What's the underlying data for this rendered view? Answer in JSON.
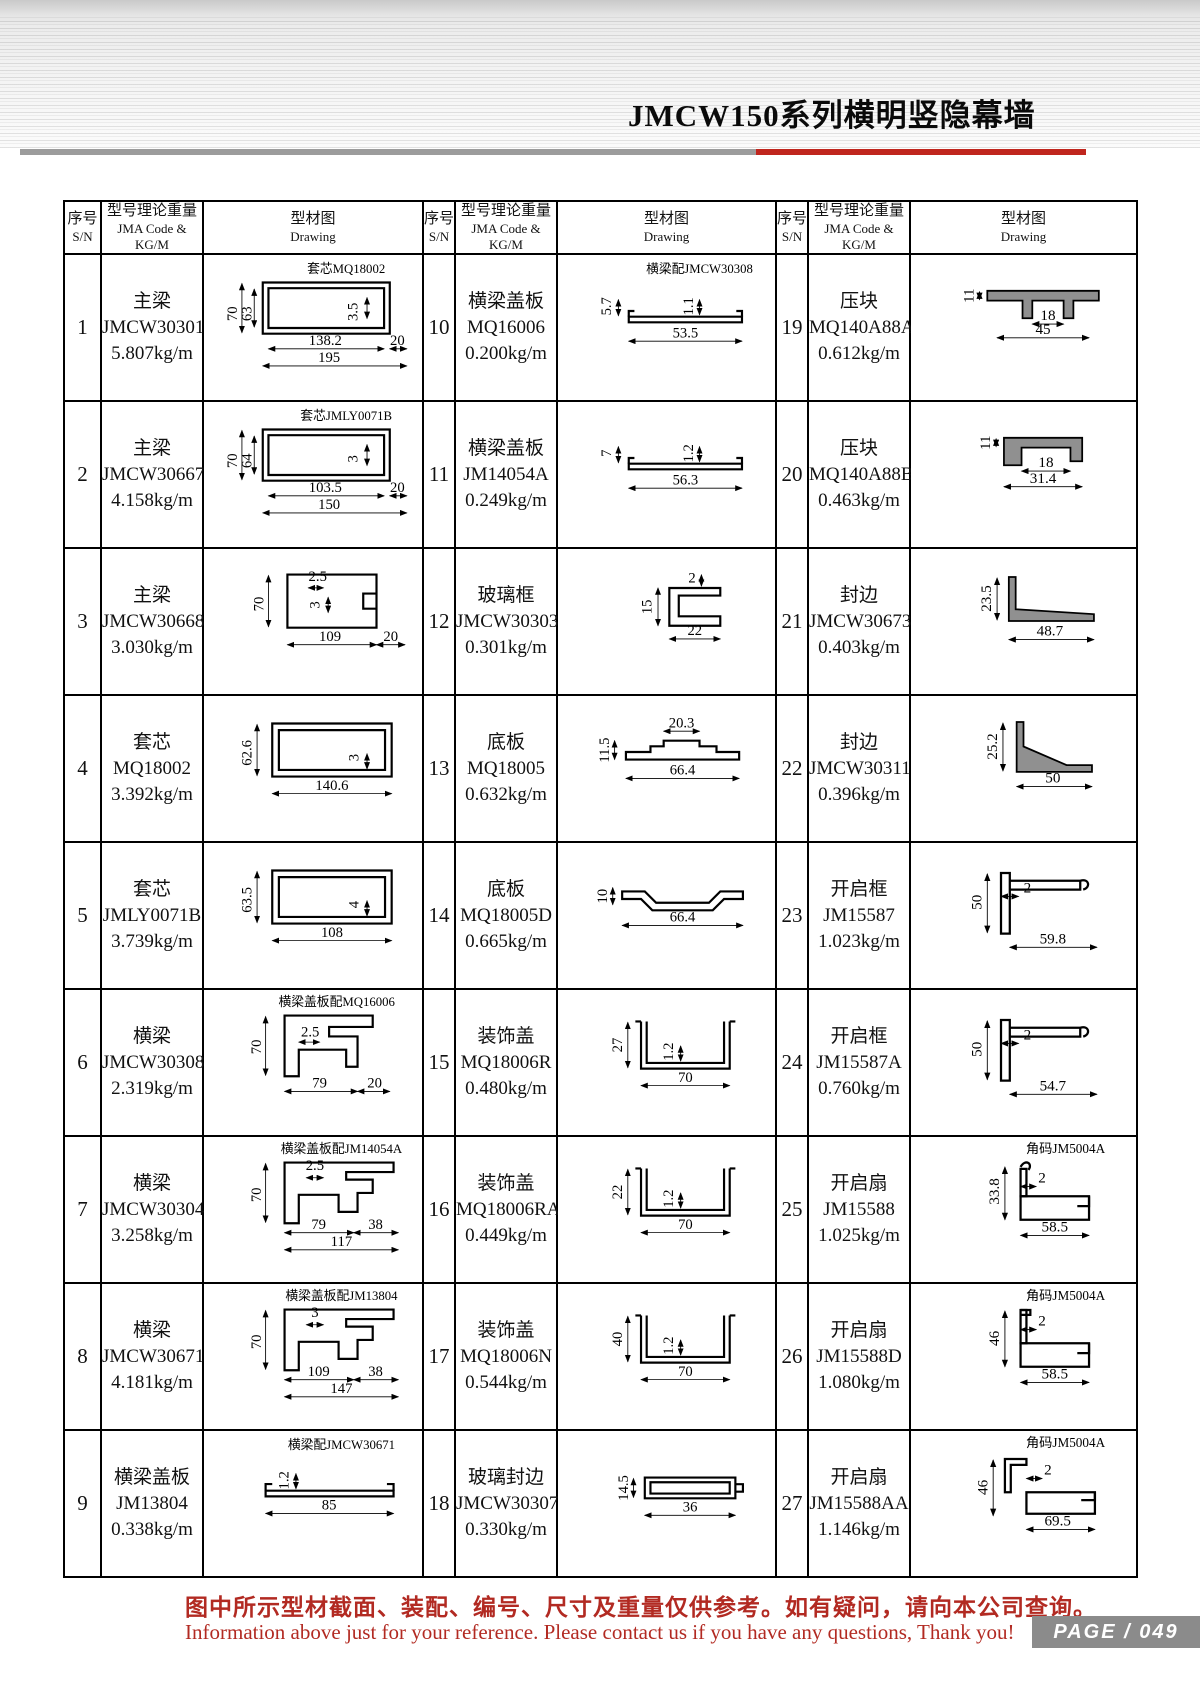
{
  "page": {
    "title": "JMCW150系列横明竖隐幕墙",
    "footer_cn": "图中所示型材截面、装配、编号、尺寸及重量仅供参考。如有疑问，请向本公司查询。",
    "footer_en": "Information above just for your reference. Please contact us if you have any questions, Thank you!",
    "page_label": "PAGE / 049",
    "colors": {
      "accent_red": "#c0261e",
      "bar_gray": "#9c9c9c",
      "page_box_gray": "#8b8b8b",
      "footer_red": "#b22a22",
      "profile_fill_gray": "#909090"
    }
  },
  "table": {
    "headers": {
      "sn_cn": "序号",
      "sn_en": "S/N",
      "code_cn": "型号理论重量",
      "code_en": "JMA Code & KG/M",
      "draw_cn": "型材图",
      "draw_en": "Drawing"
    },
    "items": [
      {
        "sn": "1",
        "name": "主梁",
        "code": "JMCW30301",
        "weight": "5.807kg/m",
        "annotation": "套芯MQ18002",
        "type": "hollow_h",
        "dims": [
          "70",
          "63",
          "3.5",
          "138.2",
          "195",
          "20"
        ]
      },
      {
        "sn": "2",
        "name": "主梁",
        "code": "JMCW30667",
        "weight": "4.158kg/m",
        "annotation": "套芯JMLY0071B",
        "type": "hollow_h",
        "dims": [
          "70",
          "64",
          "3",
          "103.5",
          "150",
          "20"
        ]
      },
      {
        "sn": "3",
        "name": "主梁",
        "code": "JMCW30668",
        "weight": "3.030kg/m",
        "type": "mullion_open",
        "dims": [
          "70",
          "2.5",
          "3",
          "109",
          "20"
        ]
      },
      {
        "sn": "4",
        "name": "套芯",
        "code": "MQ18002",
        "weight": "3.392kg/m",
        "type": "core_rect",
        "dims": [
          "62.6",
          "3",
          "140.6"
        ]
      },
      {
        "sn": "5",
        "name": "套芯",
        "code": "JMLY0071B",
        "weight": "3.739kg/m",
        "type": "core_rect",
        "dims": [
          "63.5",
          "4",
          "108"
        ]
      },
      {
        "sn": "6",
        "name": "横梁",
        "code": "JMCW30308",
        "weight": "2.319kg/m",
        "annotation": "横梁盖板配MQ16006",
        "type": "beam_a",
        "dims": [
          "70",
          "2.5",
          "79",
          "20"
        ]
      },
      {
        "sn": "7",
        "name": "横梁",
        "code": "JMCW30304",
        "weight": "3.258kg/m",
        "annotation": "横梁盖板配JM14054A",
        "type": "beam_b",
        "dims": [
          "2.5",
          "70",
          "79",
          "38",
          "117"
        ]
      },
      {
        "sn": "8",
        "name": "横梁",
        "code": "JMCW30671",
        "weight": "4.181kg/m",
        "annotation": "横梁盖板配JM13804",
        "type": "beam_b",
        "dims": [
          "3",
          "70",
          "109",
          "38",
          "147"
        ]
      },
      {
        "sn": "9",
        "name": "横梁盖板",
        "code": "JM13804",
        "weight": "0.338kg/m",
        "annotation": "横梁配JMCW30671",
        "type": "flat1",
        "dims": [
          "1.2",
          "85"
        ]
      },
      {
        "sn": "10",
        "name": "横梁盖板",
        "code": "MQ16006",
        "weight": "0.200kg/m",
        "annotation": "横梁配JMCW30308",
        "type": "flat2",
        "dims": [
          "5.7",
          "1.1",
          "53.5"
        ]
      },
      {
        "sn": "11",
        "name": "横梁盖板",
        "code": "JM14054A",
        "weight": "0.249kg/m",
        "type": "flat2",
        "dims": [
          "7",
          "1.2",
          "56.3"
        ]
      },
      {
        "sn": "12",
        "name": "玻璃框",
        "code": "JMCW30303",
        "weight": "0.301kg/m",
        "type": "c_small",
        "dims": [
          "2",
          "15",
          "22"
        ]
      },
      {
        "sn": "13",
        "name": "底板",
        "code": "MQ18005",
        "weight": "0.632kg/m",
        "type": "plate",
        "dims": [
          "20.3",
          "11.5",
          "66.4"
        ]
      },
      {
        "sn": "14",
        "name": "底板",
        "code": "MQ18005D",
        "weight": "0.665kg/m",
        "type": "plate_d",
        "dims": [
          "10",
          "66.4"
        ]
      },
      {
        "sn": "15",
        "name": "装饰盖",
        "code": "MQ18006R",
        "weight": "0.480kg/m",
        "type": "u_cover",
        "dims": [
          "27",
          "1.2",
          "70"
        ]
      },
      {
        "sn": "16",
        "name": "装饰盖",
        "code": "MQ18006RA",
        "weight": "0.449kg/m",
        "type": "u_cover",
        "dims": [
          "22",
          "1.2",
          "70"
        ]
      },
      {
        "sn": "17",
        "name": "装饰盖",
        "code": "MQ18006N",
        "weight": "0.544kg/m",
        "type": "u_cover",
        "dims": [
          "40",
          "1.2",
          "70"
        ]
      },
      {
        "sn": "18",
        "name": "玻璃封边",
        "code": "JMCW30307",
        "weight": "0.330kg/m",
        "type": "glass_edge",
        "dims": [
          "14.5",
          "36"
        ]
      },
      {
        "sn": "19",
        "name": "压块",
        "code": "MQ140A88A",
        "weight": "0.612kg/m",
        "type": "clamp_a",
        "dims": [
          "11",
          "18",
          "45"
        ]
      },
      {
        "sn": "20",
        "name": "压块",
        "code": "MQ140A88B",
        "weight": "0.463kg/m",
        "type": "clamp_b",
        "dims": [
          "11",
          "18",
          "31.4"
        ]
      },
      {
        "sn": "21",
        "name": "封边",
        "code": "JMCW30673",
        "weight": "0.403kg/m",
        "type": "l_edge",
        "dims": [
          "23.5",
          "48.7"
        ]
      },
      {
        "sn": "22",
        "name": "封边",
        "code": "JMCW30311",
        "weight": "0.396kg/m",
        "type": "z_edge",
        "dims": [
          "25.2",
          "50"
        ]
      },
      {
        "sn": "23",
        "name": "开启框",
        "code": "JM15587",
        "weight": "1.023kg/m",
        "type": "open_frame",
        "dims": [
          "50",
          "2",
          "59.8"
        ]
      },
      {
        "sn": "24",
        "name": "开启框",
        "code": "JM15587A",
        "weight": "0.760kg/m",
        "type": "open_frame",
        "dims": [
          "50",
          "2",
          "54.7"
        ]
      },
      {
        "sn": "25",
        "name": "开启扇",
        "code": "JM15588",
        "weight": "1.025kg/m",
        "annotation": "角码JM5004A",
        "type": "sash",
        "dims": [
          "33.8",
          "2",
          "58.5"
        ]
      },
      {
        "sn": "26",
        "name": "开启扇",
        "code": "JM15588D",
        "weight": "1.080kg/m",
        "annotation": "角码JM5004A",
        "type": "sash_b",
        "dims": [
          "46",
          "2",
          "58.5"
        ]
      },
      {
        "sn": "27",
        "name": "开启扇",
        "code": "JM15588AA",
        "weight": "1.146kg/m",
        "annotation": "角码JM5004A",
        "type": "sash_c",
        "dims": [
          "46",
          "2",
          "69.5"
        ]
      }
    ]
  }
}
